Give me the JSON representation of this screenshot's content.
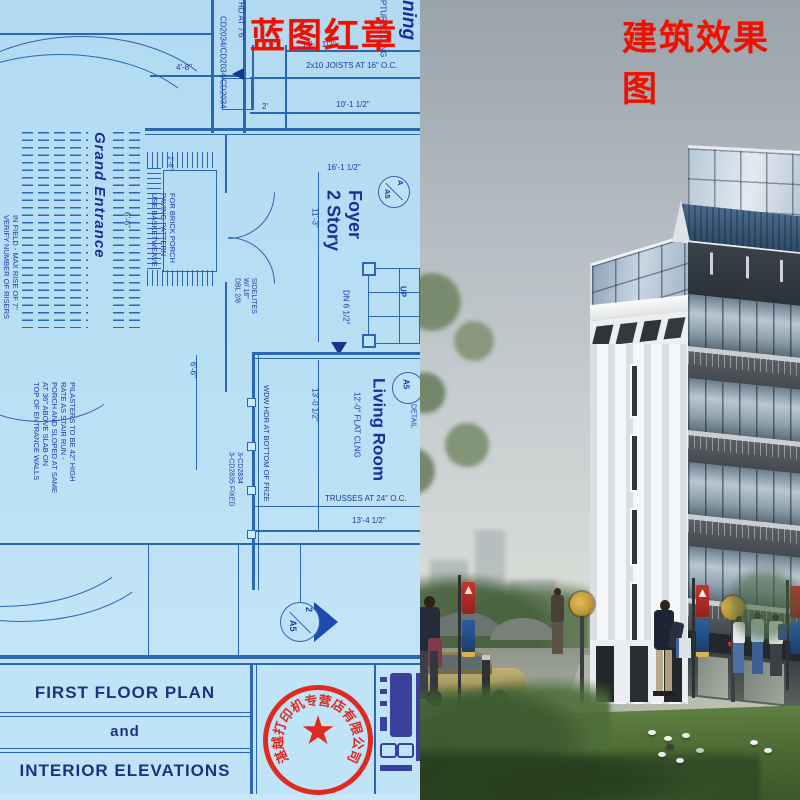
{
  "labels": {
    "left": "蓝图红章",
    "right": "建筑效果图"
  },
  "colors": {
    "blueprint_bg": "#b9dff5",
    "blueprint_line": "#2b67b2",
    "blueprint_text": "#1d3aa0",
    "label_red": "#ee1000",
    "stamp_red": "#e02a20",
    "sky_top": "#9aa2aa",
    "grass": "#4c6a33"
  },
  "blueprint": {
    "rooms": {
      "grand_entrance": "Grand Entrance",
      "foyer_line1": "2 Story",
      "foyer_line2": "Foyer",
      "living_room": "Living Room",
      "dining_partial": "ning"
    },
    "dimensions": {
      "d_4_8": "4'-8\"",
      "d_14_1": "14'-1 1/2\"",
      "d_10_1": "10'-1 1/2\"",
      "d_2": "2'",
      "d_16_1": "16'-1 1/2\"",
      "d_11_3": "11'-3\"",
      "d_13_0": "13'-0 1/2\"",
      "d_13_4": "13'-4 1/2\"",
      "d_6_6a": "6'-6\"",
      "d_6_6b": "6'-6\"",
      "d_2_6": "2'-6\""
    },
    "notes": {
      "cd_series": "CD2034/CD2034/CD2034",
      "hd_at": "HD AT 7'6\"",
      "joists": "2x10 JOISTS AT 16\" O.C.",
      "sculptured": "PTURED CLNG",
      "flat_clng": "12'-0\" FLAT CLNG",
      "trusses": "TRUSSES AT 24\" O.C.",
      "dn": "DN 6 1/2\"",
      "up": "UP",
      "wdw": "WDW HDR AT BOTTOM OF FRZE",
      "fixed1": "3-CD2835 FIXED",
      "fixed2": "3-CD2834",
      "basketweave": [
        "USE BASKETWEAVE",
        "PAVING PATTERN",
        "FOR BRICK PORCH"
      ],
      "dbl": [
        "DBL 2/8",
        "W/ 16\"",
        "SIDELITES"
      ],
      "verify": [
        "VERIFY NUMBER OF RISERS",
        "IN FIELD - MAX RISE OF 7\""
      ],
      "top_walls": [
        "TOP OF ENTRANCE WALLS",
        "AT 36\" ABOVE SLAB ON",
        "PORCH AND SLOPED AT SAME",
        "RATE AS STAIR RUN -",
        "PILASTERS TO BE 42\" HIGH"
      ]
    },
    "markers": {
      "foyer_letter": "A",
      "foyer_sheet": "A5",
      "living_sheet": "A5",
      "living_detail": "DETAIL",
      "bottom_number": "2",
      "bottom_sheet": "A5"
    },
    "title_block": {
      "line1": "FIRST FLOOR PLAN",
      "line2": "and",
      "line3": "INTERIOR ELEVATIONS"
    }
  },
  "stamp": {
    "text": "湛越打印机专营店有限公司",
    "star": "★"
  }
}
